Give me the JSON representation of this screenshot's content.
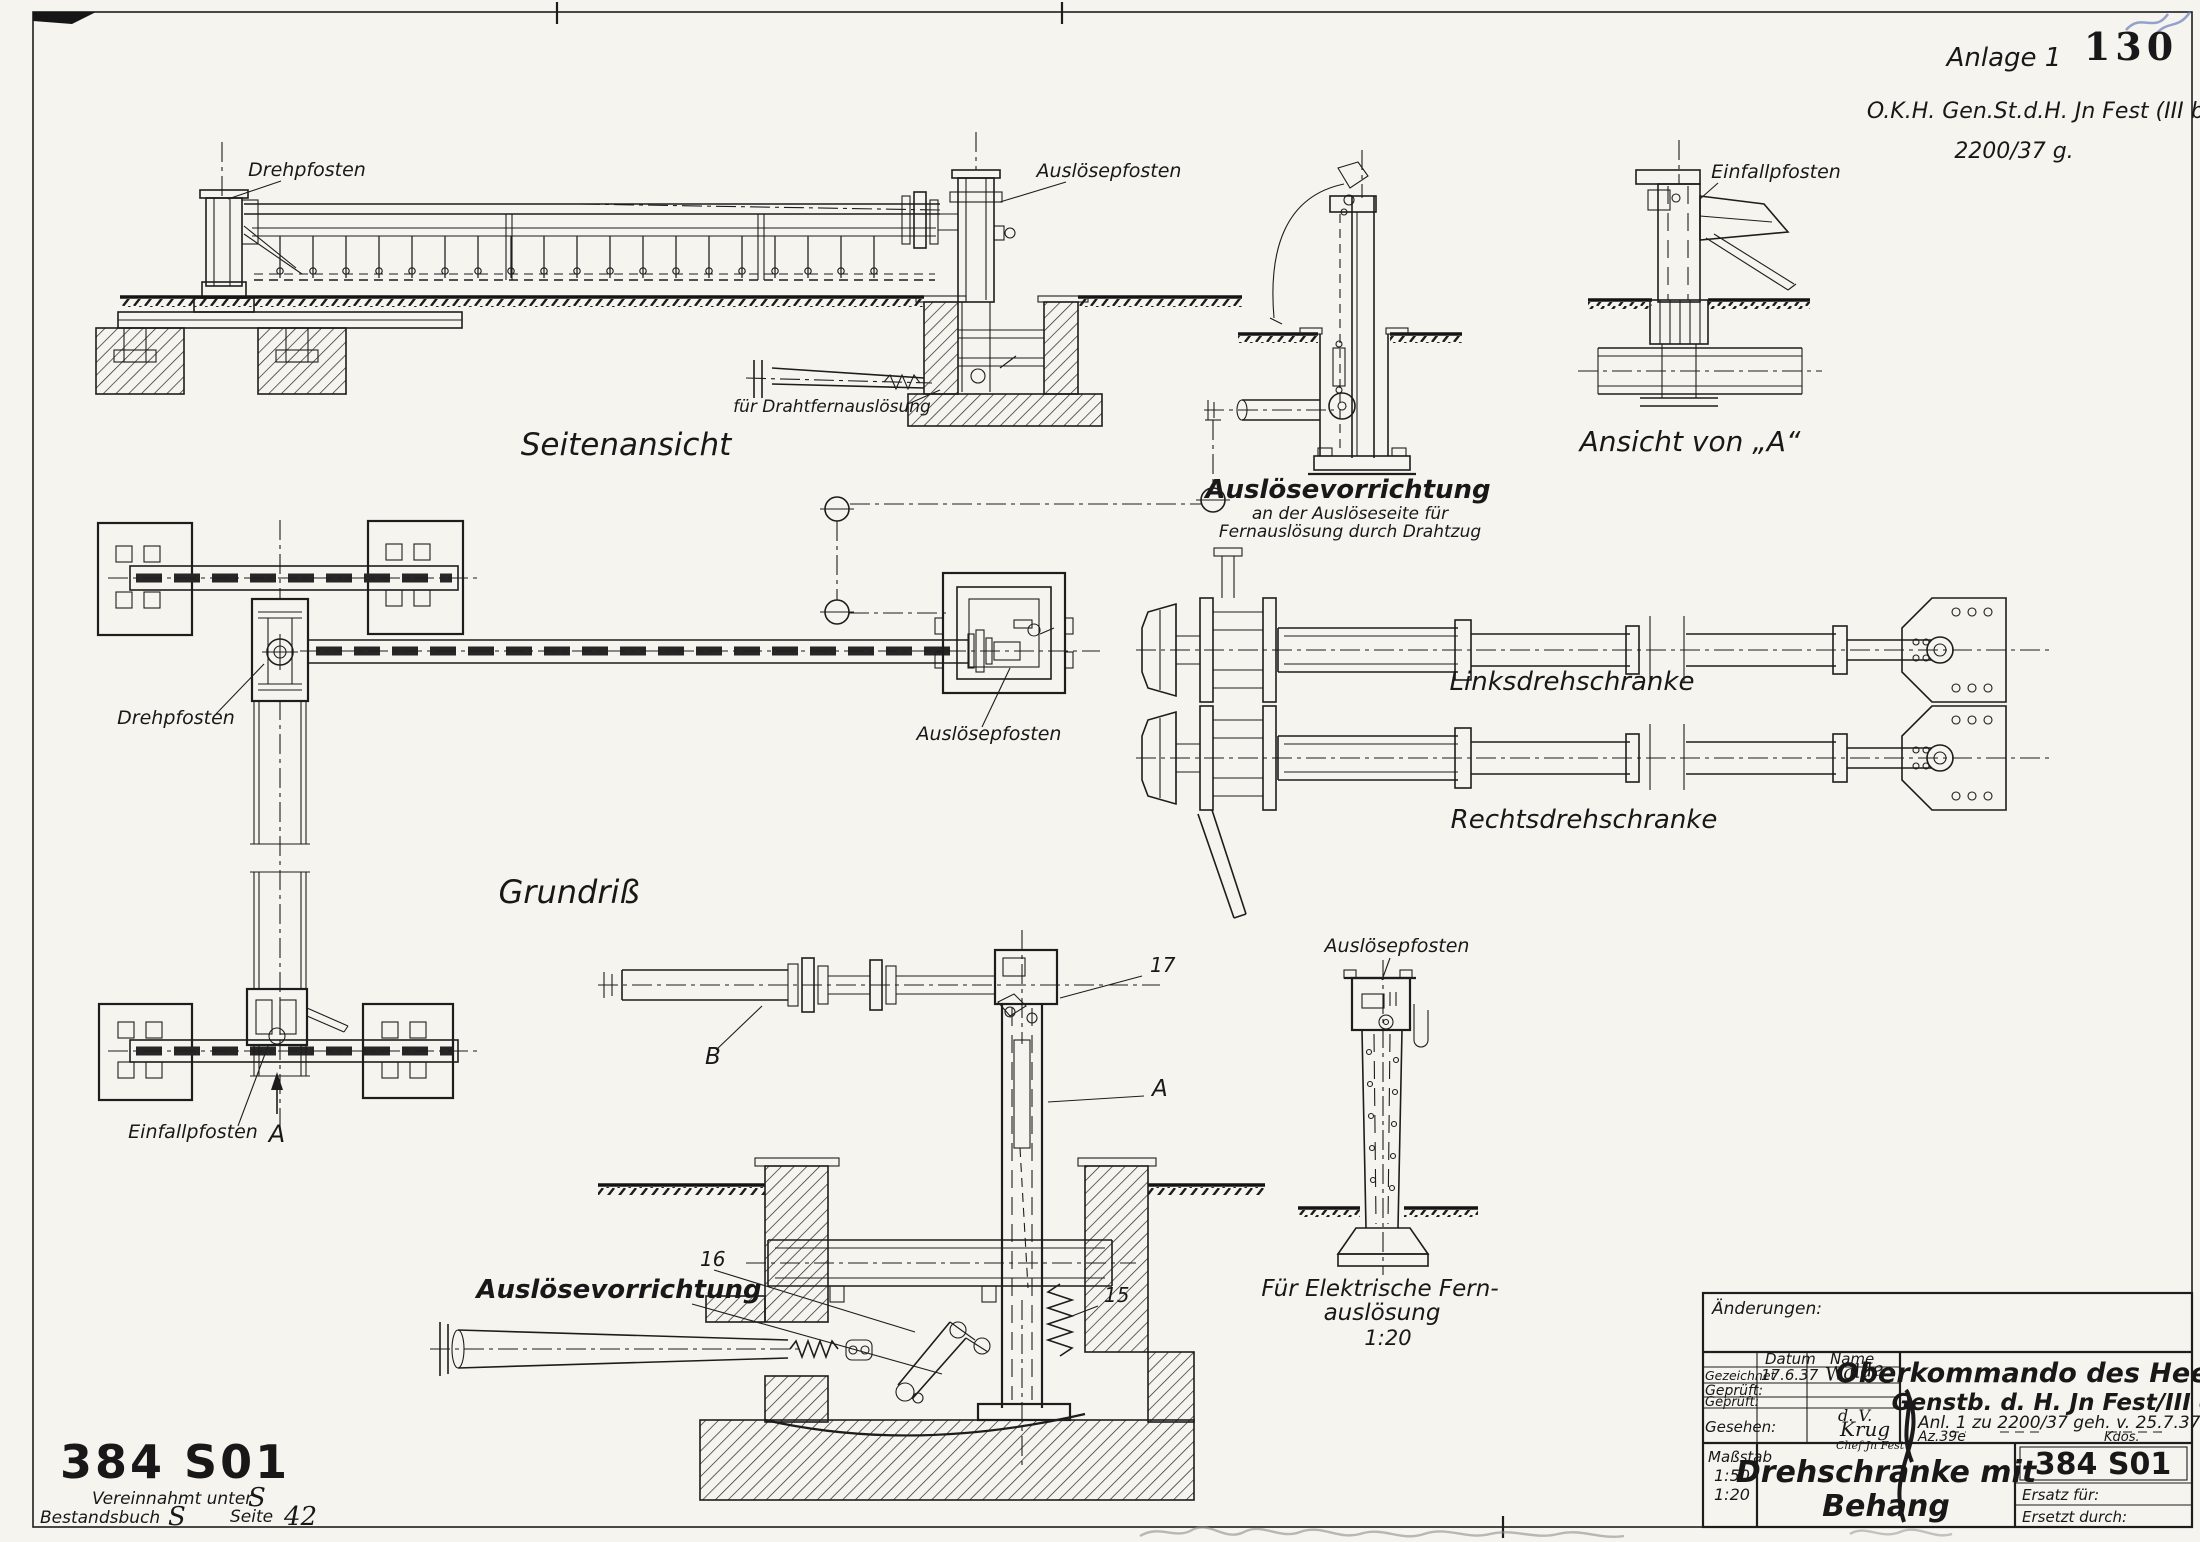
{
  "header": {
    "annex": "Anlage 1",
    "page_stamp": "130",
    "org": "O.K.H. Gen.St.d.H. Jn Fest (III b)",
    "file_no": "2200/37 g."
  },
  "side_view": {
    "title": "Seitenansicht",
    "drehpfosten": "Drehpfosten",
    "ausloesepfosten": "Auslösepfosten",
    "drahtfern": "für Drahtfernauslösung"
  },
  "release_top": {
    "line1": "Auslösevorrichtung",
    "line2": "an der  Auslöseseite für",
    "line3": "Fernauslösung durch Drahtzug"
  },
  "view_a": {
    "title": "Ansicht von „A“",
    "einfallpfosten": "Einfallpfosten"
  },
  "plan": {
    "title": "Grundriß",
    "drehpfosten": "Drehpfosten",
    "einfallpfosten": "Einfallpfosten",
    "ausloesepfosten": "Auslösepfosten",
    "arrow": "A"
  },
  "barriers": {
    "left": "Linksdrehschranke",
    "right": "Rechtsdrehschranke"
  },
  "detail": {
    "label": "Auslösevorrichtung",
    "p15": "15",
    "p16": "16",
    "p17": "17",
    "a": "A",
    "b": "B"
  },
  "electric": {
    "ausloesepfosten": "Auslösepfosten",
    "cap1": "Für Elektrische Fern-",
    "cap2": "auslösung",
    "scale": "1:20"
  },
  "stamp": {
    "number": "384 S01",
    "l1a": "Vereinnahmt unter",
    "l1b": "S",
    "l2a": "Bestandsbuch",
    "l2b": "S",
    "l2c": "Seite",
    "l2d": "42"
  },
  "tb": {
    "changes": "Änderungen:",
    "datum": "Datum",
    "name": "Name",
    "gezeichnet": "Gezeichnet",
    "gez_date": "17.6.37",
    "gez_sig": "Walde",
    "geprueft1": "Geprüft:",
    "geprueft2": "Geprüft:",
    "gesehen": "Gesehen:",
    "sig_dv": "d. V.",
    "sig_krug": "Krug",
    "sig_chef": "Chef Jn Fest",
    "org1": "Oberkommando des Heeres",
    "org2": "Genstb. d. H. Jn Fest/III c",
    "ref": "Anl. 1  zu 2200/37 geh. v. 25.7.37",
    "az": "Az.39e",
    "kdos": "Kdos.",
    "massstab": "Maßstab",
    "scale1": "1:50",
    "scale2": "1:20",
    "title1": "Drehschranke mit",
    "title2": "Behang",
    "number": "384 S01",
    "ersatz": "Ersatz für:",
    "ersetzt": "Ersetzt durch:"
  }
}
